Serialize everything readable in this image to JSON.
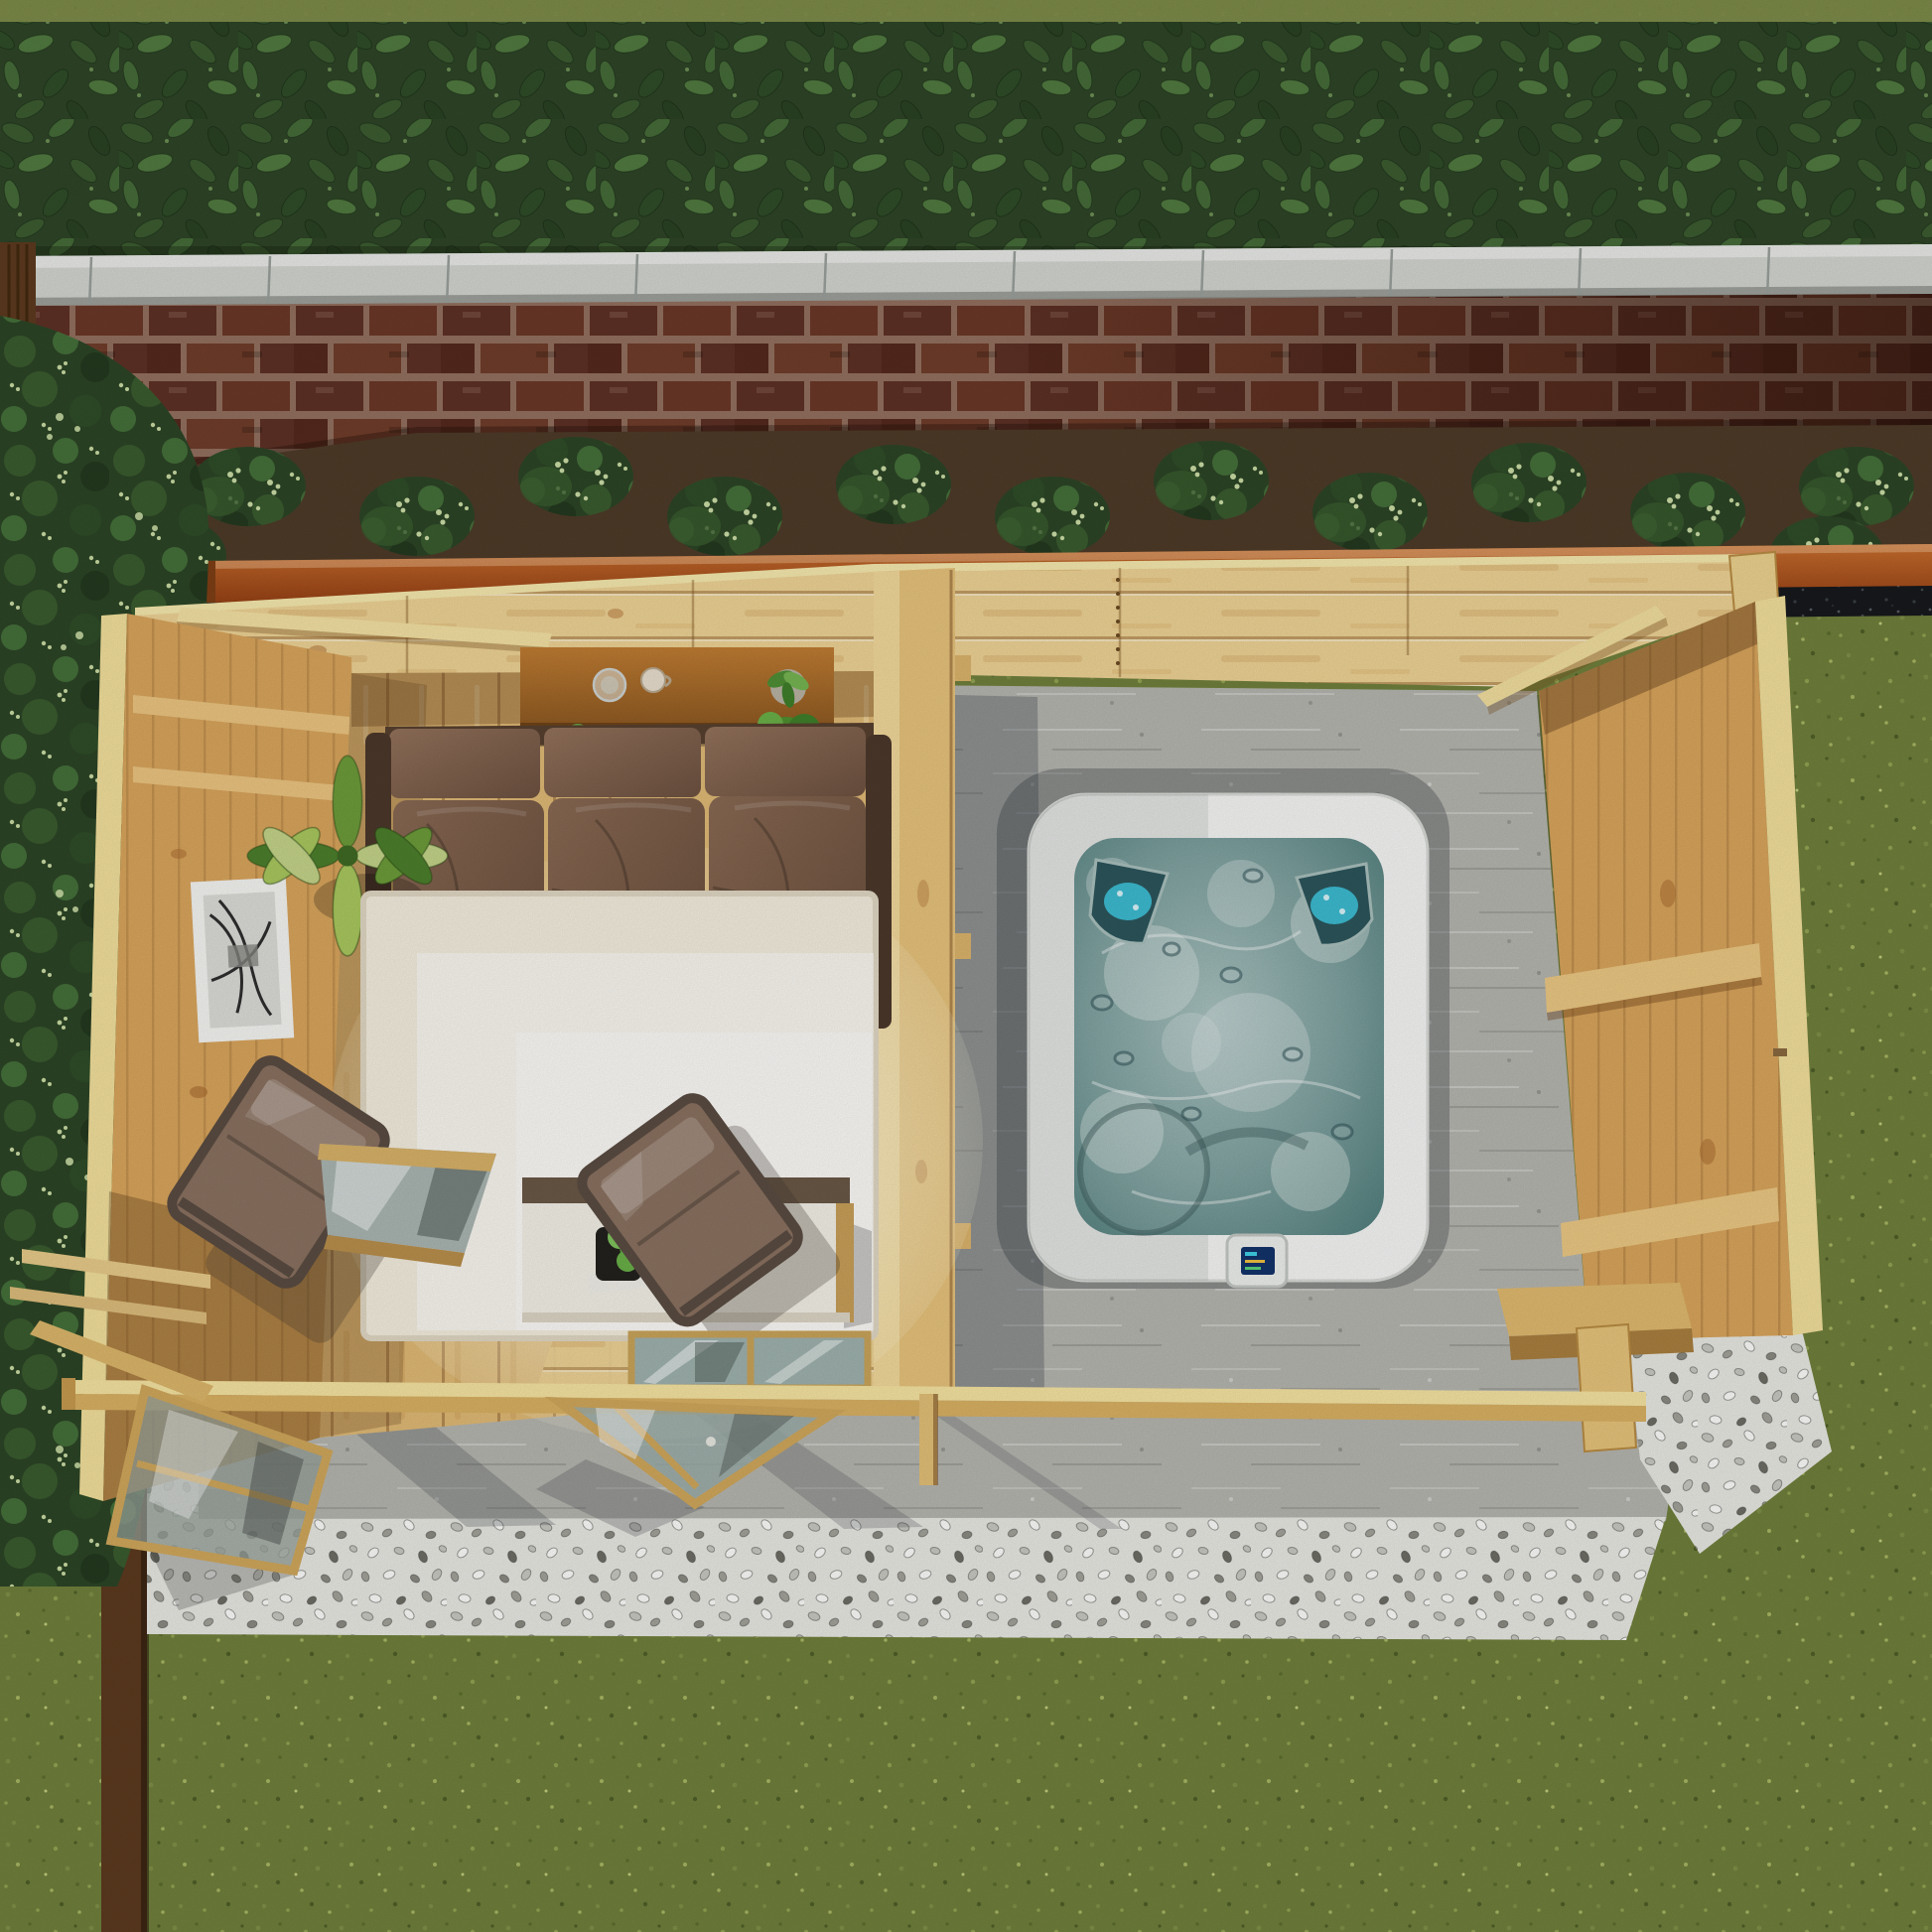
{
  "scene": {
    "description": "Aerial top-down render of a timber garden cabin with lounge interior and open hot tub canopy, brick wall and hedge behind, lawn and gravel around",
    "counts": {
      "sofa_seat_cushions": 3,
      "armchairs": 2,
      "hot_tub_headrests": 2,
      "open_door_leaves": 2,
      "flat_glazed_door_panels": 2,
      "coping_joint_lines": 10
    }
  },
  "palette": {
    "lawn": "#70803c",
    "lawn_light": "#7e8c4a",
    "hedge_green": "#2e4527",
    "coping_grey": "#d3d5d0",
    "mortar": "#93705f",
    "brick_red": "#5e3125",
    "soil_brown": "#4e3b28",
    "shrub_green": "#2c4526",
    "flower_cream": "#cbdda6",
    "fence_orange": "#b05a21",
    "fence_dark": "#5c3a1f",
    "mulch_dark": "#17191c",
    "gravel_light": "#e9e9e4",
    "concrete_grey": "#b6b6b0",
    "pine_bright": "#eed395",
    "pine_mid": "#e0ba76",
    "pine_warm": "#d9a55c",
    "pine_rim": "#f2e09c",
    "pine_face": "#d9b163",
    "beam_top": "#f6e4a1",
    "sideboard_brown": "#b5742f",
    "sofa_frame": "#57402f",
    "cushion_brown": "#7f604b",
    "rug_cream": "#f4eede",
    "table_white": "#f3f0e7",
    "wood_edge": "#c89f58",
    "chair_fabric": "#8a7160",
    "chair_frame": "#5a4c42",
    "plant_green": "#6d9c3a",
    "tub_shell": "#f6f7f5",
    "water_teal": "#7fa2a0",
    "seat_aqua": "#3fc6de",
    "glass_blue": "#9fb2ae",
    "screen_blue": "#13336b",
    "frame_white": "#f5f5f2"
  }
}
